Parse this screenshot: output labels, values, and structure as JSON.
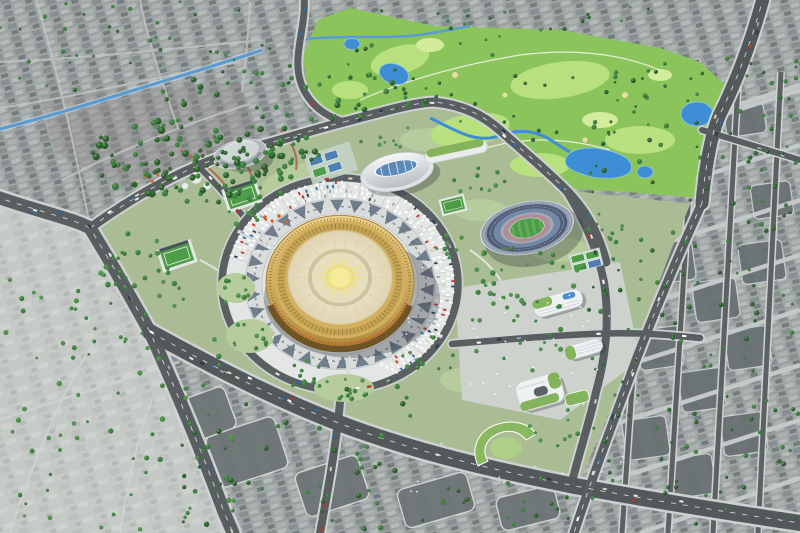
{
  "meta": {
    "description": "Aerial bird's-eye 3D architectural rendering of a sports and culture complex master plan surrounded by existing city fabric",
    "style": "photorealistic CGI daylight render",
    "visible_text": "none"
  },
  "landmarks": [
    {
      "id": "golden-stadium",
      "label": "Golden circular domed stadium with sunburst roof"
    },
    {
      "id": "ceremonial-plaza",
      "label": "Circular plaza with dark triangular ethnic patterns and radial parking"
    },
    {
      "id": "oval-stadium",
      "label": "Oval football stadium with blue seating tiers and green pitch"
    },
    {
      "id": "indoor-arena",
      "label": "Ellipse indoor arena with glazed blue roof"
    },
    {
      "id": "small-dome-hall",
      "label": "Small grey domed sports hall"
    },
    {
      "id": "golf-course",
      "label": "Bright green golf course with ponds and winding creek"
    },
    {
      "id": "golf-clubhouse",
      "label": "Curved green-roof clubhouse"
    },
    {
      "id": "office-complex",
      "label": "White curved office buildings with green roofs and rooftop pools"
    },
    {
      "id": "sports-fields",
      "label": "Fenced football pitches and tennis courts"
    },
    {
      "id": "canal",
      "label": "Blue canal crossing the north-west district"
    },
    {
      "id": "city-fabric",
      "label": "Dense grey city blocks dotted with trees"
    },
    {
      "id": "road-network",
      "label": "Wide boulevards, ring road and gridded side streets with traffic"
    }
  ],
  "palette": {
    "city_base": "#a2a8a8",
    "field": "#c6cac7",
    "park": "#a9bc93",
    "park_lawn": "#b6cc9c",
    "golf": "#8cc45c",
    "golf_light": "#b9e07e",
    "golf_pale": "#d2ec9c",
    "sand": "#e9dca6",
    "water": "#3d8ed4",
    "canal": "#5b9bd0",
    "road": "#595e61",
    "road_dark": "#53585b",
    "road_casing": "#cdd1d1",
    "curb": "#d6d9d8",
    "plaza": "#d9dcdb",
    "plaza_inner": "#e4e6e4",
    "plaza_pattern": "#5e6e7e",
    "parking": "#e4e6e6",
    "gold_deep": "#b08a3e",
    "gold": "#d4af5e",
    "gold_light": "#ecd28b",
    "ivory": "#eee6cd",
    "sun": "#f4eb9b",
    "sun_ray": "#efe27b",
    "arcade_dark": "#6f5426",
    "arcade_orange": "#c4622d",
    "tier_dark": "#4f5d77",
    "tier_mid": "#7488a6",
    "tier_light": "#8d99ad",
    "stadium_rim": "#9fabbb",
    "track": "#b08e96",
    "pitch": "#4d9c47",
    "shell": "#eef1f2",
    "glass_blue": "#5d89b8",
    "dome_grey": "#b0b7ba",
    "dome_grey_light": "#d0d6d8",
    "roof_green": "#84b35e",
    "pool_blue": "#4f8fd0",
    "block_dark": "#687072",
    "court_blue": "#4f7fae",
    "court_green": "#4d9c47",
    "accent_orange": "#d2622e",
    "shadow": "rgba(40,45,52,0.30)"
  },
  "generator": {
    "seed": 1337,
    "car_colors": [
      "#ffffff",
      "#e4e6e7",
      "#c0392b",
      "#2c3e50",
      "#9aa5ab",
      "#3a6ea5",
      "#d8d0c0"
    ],
    "tree_greens": [
      "#2d5a2f",
      "#3c7a40",
      "#4e8c4a"
    ],
    "tree_highlight": "#5fa457",
    "pedestrian_color": "#ffffff"
  }
}
